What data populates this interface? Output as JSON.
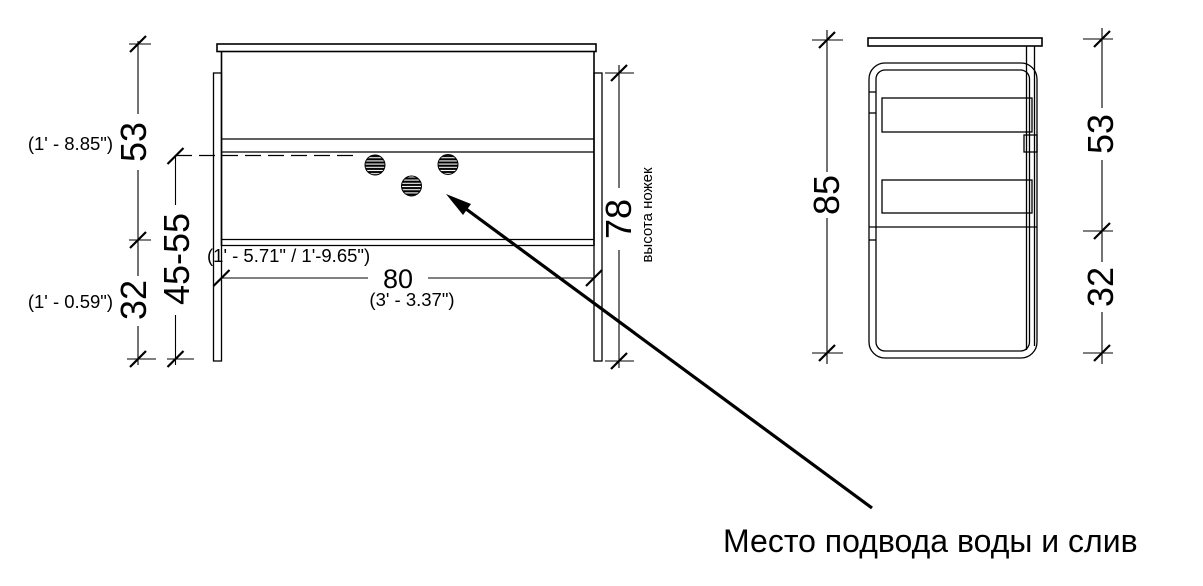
{
  "front_view": {
    "dim_body_height": "53",
    "dim_body_height_imperial": "(1' - 8.85\")",
    "dim_bottom_clearance": "32",
    "dim_bottom_clearance_imperial": "(1' - 0.59\")",
    "dim_water_level_range": "45-55",
    "dim_water_level_range_imperial": "(1' - 5.71\" / 1'-9.65\")",
    "dim_width": "80",
    "dim_width_imperial": "(3' - 3.37\")",
    "dim_leg_height": "78",
    "leg_height_note": "высота ножек"
  },
  "side_view": {
    "dim_total_height": "85",
    "dim_body_height": "53",
    "dim_bottom_clearance": "32"
  },
  "callout": {
    "label": "Место подвода воды и слив"
  },
  "colors": {
    "line": "#000000",
    "background": "#ffffff"
  }
}
